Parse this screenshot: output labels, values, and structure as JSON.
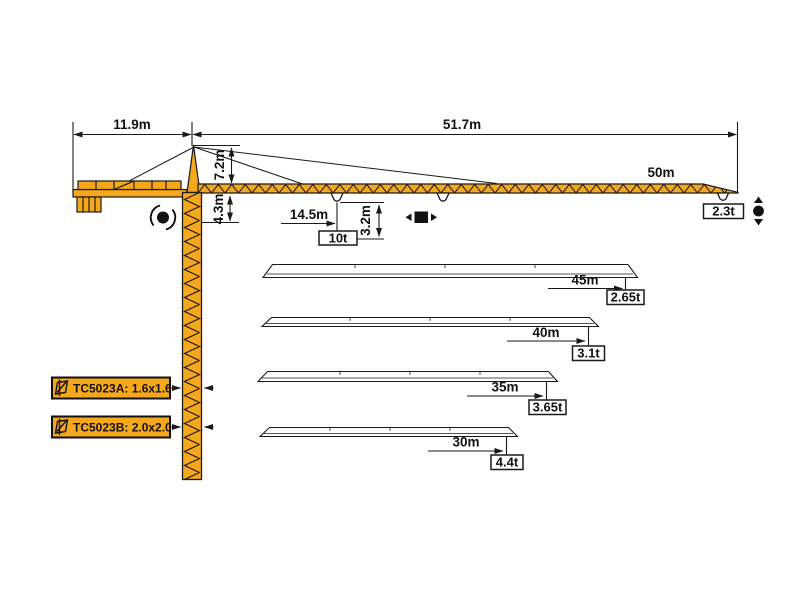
{
  "diagram": {
    "background": "#ffffff",
    "crane_color": "#F6A81C",
    "line_color": "#1a1a1a",
    "dimensions": {
      "counter_jib_length": "11.9m",
      "working_span": "51.7m",
      "apex_height": "7.2m",
      "under_jib_height": "4.3m",
      "load_radius": "14.5m",
      "hook_drop": "3.2m"
    },
    "loads": {
      "jib_length": "50m",
      "mid_load": "10t",
      "tip_load": "2.3t"
    },
    "jib_variants": [
      {
        "length": "45m",
        "tip_load": "2.65t"
      },
      {
        "length": "40m",
        "tip_load": "3.1t"
      },
      {
        "length": "35m",
        "tip_load": "3.65t"
      },
      {
        "length": "30m",
        "tip_load": "4.4t"
      }
    ],
    "mast_sections": [
      {
        "label": "TC5023A: 1.6x1.6"
      },
      {
        "label": "TC5023B: 2.0x2.0"
      }
    ],
    "icons": {
      "slewing": "slewing-rotation",
      "trolley": "trolley-travel",
      "hoist": "hook-hoisting",
      "mast_section": "mast-cross-section"
    }
  }
}
